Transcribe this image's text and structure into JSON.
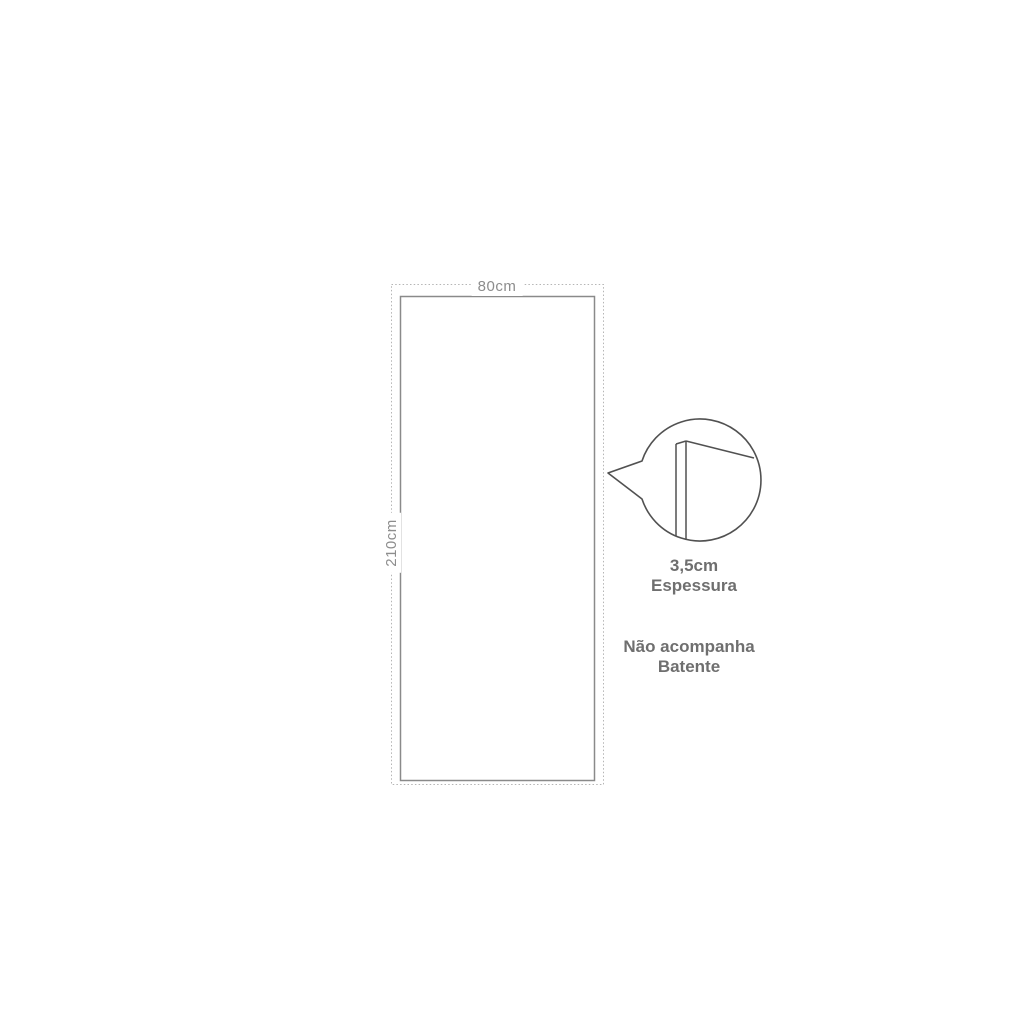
{
  "diagram": {
    "door": {
      "width_label": "80cm",
      "height_label": "210cm"
    },
    "callout": {
      "thickness_value": "3,5cm",
      "thickness_label": "Espessura"
    },
    "note": {
      "line1": "Não acompanha",
      "line2": "Batente"
    },
    "colors": {
      "background": "#ffffff",
      "dotted_outline": "#b5b5b5",
      "door_outline": "#8a8a8a",
      "callout_stroke": "#515151",
      "dimension_text": "#8d8d8d",
      "note_text": "#6f6f6f"
    }
  }
}
